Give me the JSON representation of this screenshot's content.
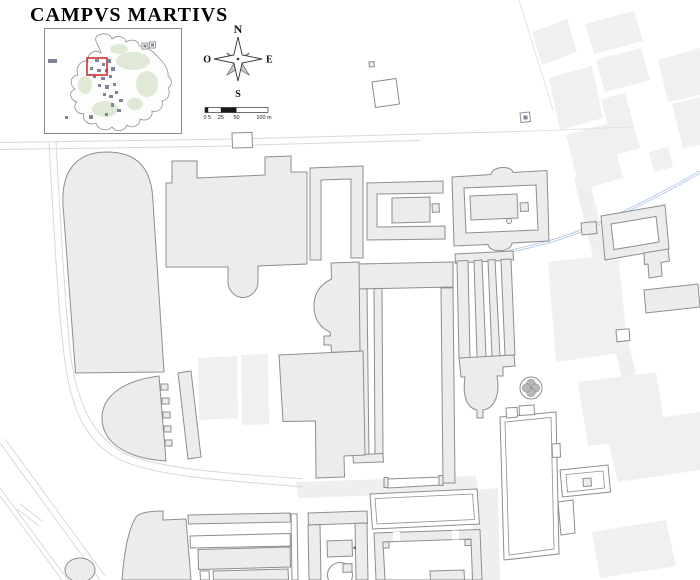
{
  "title": "CAMPVS MARTIVS",
  "compass": {
    "north": "N",
    "east": "E",
    "south": "S",
    "west": "O"
  },
  "scale_bar": {
    "t0": "0",
    "t5": "5",
    "t25": "25",
    "t50": "50",
    "t100": "100 m"
  },
  "colors": {
    "building": "#ececec",
    "outline": "#8e8e8e",
    "faint": "#f0f0f0",
    "road": "#d9d9d9",
    "aqueduct": "#b5c9e4",
    "accent": "#d03232",
    "green": "#dfe9d5",
    "mark": "#7c8697",
    "ink": "#1a1a1a"
  }
}
